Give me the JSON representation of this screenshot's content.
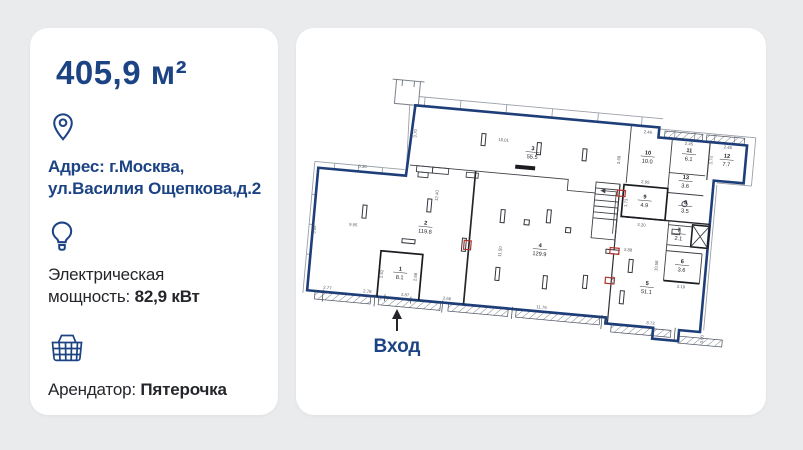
{
  "palette": {
    "page_bg": "#eaebed",
    "accent_navy": "#1c4383",
    "wall_blue": "#1e3e79",
    "text_dark": "#24262b",
    "red_accent": "#b23228"
  },
  "left_card": {
    "area_title": "405,9 м²",
    "address": {
      "icon": "location-pin-icon",
      "line1": "Адрес: г.Москва,",
      "line2": "ул.Василия Ощепкова,д.2"
    },
    "power": {
      "icon": "lightbulb-icon",
      "label_line1": "Электрическая",
      "label_line2": "мощность:",
      "value": "82,9 кВт"
    },
    "tenant": {
      "icon": "basket-icon",
      "label": "Арендатор:",
      "value": "Пятерочка"
    }
  },
  "floorplan": {
    "entrance_label": "Вход",
    "rooms": [
      {
        "num": "1",
        "area": "8.1",
        "x": 91,
        "y": 158
      },
      {
        "num": "2",
        "area": "119.8",
        "x": 112,
        "y": 110
      },
      {
        "num": "3",
        "area": "55.5",
        "x": 212,
        "y": 26
      },
      {
        "num": "4",
        "area": "129.9",
        "x": 228,
        "y": 122
      },
      {
        "num": "5",
        "area": "51.1",
        "x": 338,
        "y": 150
      },
      {
        "num": "6",
        "area": "3.6",
        "x": 371,
        "y": 125
      },
      {
        "num": "7",
        "area": "2.1",
        "x": 365,
        "y": 94
      },
      {
        "num": "8",
        "area": "3.5",
        "x": 369,
        "y": 66
      },
      {
        "num": "9",
        "area": "4.9",
        "x": 328,
        "y": 64
      },
      {
        "num": "10",
        "area": "10.0",
        "x": 327,
        "y": 20
      },
      {
        "num": "11",
        "area": "6.1",
        "x": 368,
        "y": 14
      },
      {
        "num": "12",
        "area": "7.7",
        "x": 406,
        "y": 16
      },
      {
        "num": "13",
        "area": "3.6",
        "x": 367,
        "y": 41
      }
    ],
    "dimensions": [
      {
        "t": "18.01",
        "x": 182,
        "y": 20,
        "r": 0
      },
      {
        "t": "6.30",
        "x": 44,
        "y": 59,
        "r": 0
      },
      {
        "t": "3.70",
        "x": 95,
        "y": 20,
        "r": -90
      },
      {
        "t": "12.40",
        "x": 122,
        "y": 80,
        "r": -90
      },
      {
        "t": "9.95",
        "x": 40,
        "y": 118,
        "r": 0
      },
      {
        "t": "5.86",
        "x": 3,
        "y": 125,
        "r": -90
      },
      {
        "t": "11.50",
        "x": 190,
        "y": 130,
        "r": -90
      },
      {
        "t": "3.68",
        "x": 300,
        "y": 28,
        "r": -90
      },
      {
        "t": "2.95",
        "x": 327,
        "y": 49,
        "r": 0
      },
      {
        "t": "1.73",
        "x": 311,
        "y": 70,
        "r": -90
      },
      {
        "t": "3.20",
        "x": 327,
        "y": 92,
        "r": 0
      },
      {
        "t": "2.88",
        "x": 316,
        "y": 118,
        "r": 0
      },
      {
        "t": "8.87",
        "x": 305,
        "y": 148,
        "r": -90
      },
      {
        "t": "2.46",
        "x": 325,
        "y": -1,
        "r": 0
      },
      {
        "t": "2.45",
        "x": 367,
        "y": 7,
        "r": 0
      },
      {
        "t": "2.46",
        "x": 406,
        "y": 7,
        "r": 0
      },
      {
        "t": "3.74",
        "x": 392,
        "y": 20,
        "r": -90
      },
      {
        "t": "10.58",
        "x": 347,
        "y": 130,
        "r": -90
      },
      {
        "t": "2.19",
        "x": 372,
        "y": 150,
        "r": 0
      },
      {
        "t": "2.77",
        "x": 20,
        "y": 183,
        "r": 0
      },
      {
        "t": "2.78",
        "x": 60,
        "y": 183,
        "r": 0
      },
      {
        "t": "2.87",
        "x": 98,
        "y": 183,
        "r": 0
      },
      {
        "t": "2.66",
        "x": 140,
        "y": 183,
        "r": 0
      },
      {
        "t": "11.76",
        "x": 235,
        "y": 183,
        "r": 0
      },
      {
        "t": "8.72",
        "x": 345,
        "y": 189,
        "r": 0
      },
      {
        "t": "3.90",
        "x": 399,
        "y": 199,
        "r": -90
      },
      {
        "t": "2.62",
        "x": 74,
        "y": 163,
        "r": -90
      },
      {
        "t": "2.68",
        "x": 108,
        "y": 163,
        "r": -90
      }
    ]
  }
}
